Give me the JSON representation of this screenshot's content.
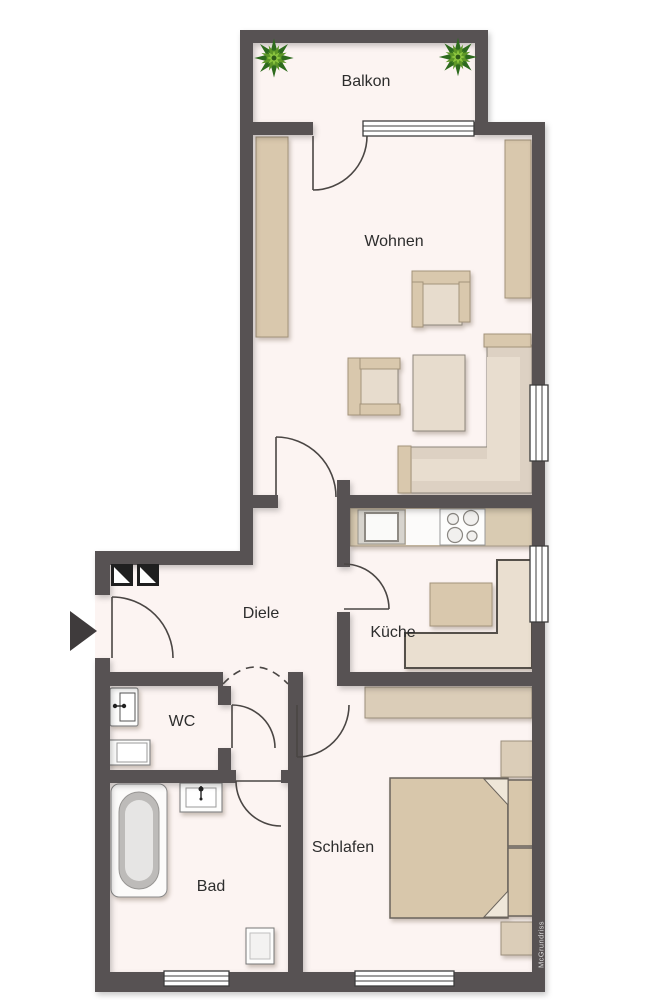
{
  "floorplan": {
    "watermark": "McGrundriss",
    "rooms": [
      {
        "id": "balkon",
        "label": "Balkon"
      },
      {
        "id": "wohnen",
        "label": "Wohnen"
      },
      {
        "id": "diele",
        "label": "Diele"
      },
      {
        "id": "kueche",
        "label": "Küche"
      },
      {
        "id": "wc",
        "label": "WC"
      },
      {
        "id": "bad",
        "label": "Bad"
      },
      {
        "id": "schlafen",
        "label": "Schlafen"
      }
    ],
    "colors": {
      "wall": "#575253",
      "floor": "#fcf4f2",
      "outside": "#ffffff",
      "furniture_tan": "#d9c8ad",
      "furniture_light": "#e7dccd",
      "bench_fill": "#eadfd0",
      "counter": "#d9cbb2",
      "bed_fill": "#d8c7ab",
      "door_stroke": "#4a4644",
      "plant_dark": "#2e6b1e",
      "plant_mid": "#5d9727",
      "plant_light": "#8cc63f",
      "arrow": "#3f3b3c",
      "label": "#2d2d2d"
    },
    "icons": {
      "entrance_arrow": "right-pointing-triangle",
      "plant": "star-foliage",
      "shaft": "black-square-white-triangle"
    }
  }
}
